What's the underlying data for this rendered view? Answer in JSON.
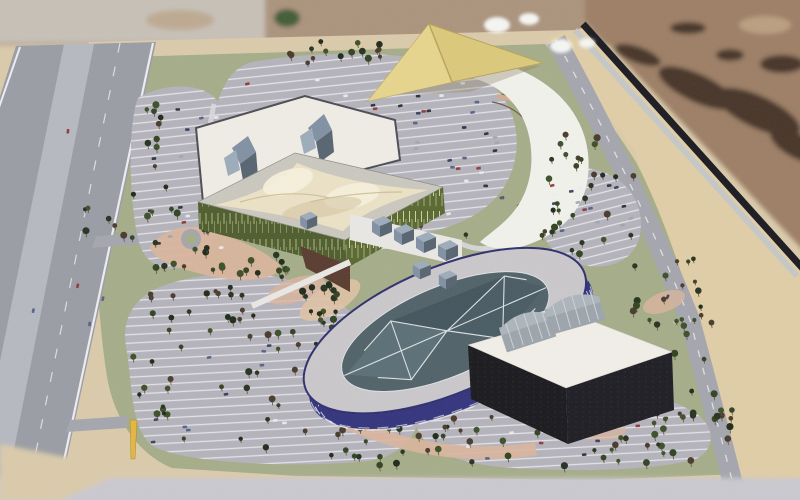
{
  "meta": {
    "description": "Photograph of an architectural scale model (site master plan maquette) showing an exhibition complex with an oval pavilion, tensile-roof hall, parking lots, trees, a highway and desert background",
    "image_type": "photo-of-physical-model"
  },
  "palette": {
    "ground": "#d8c8a8",
    "board_green": "#a3aa86",
    "top_blur": "#a8917a",
    "top_blur_light": "#c4beb4",
    "green_blob": "#3f5a36",
    "desert": "#9a7c62",
    "desert_shadow": "#453226",
    "desert_light": "#b89c7e",
    "bottom_blur": "#c8c6cd",
    "board_edge": "#17171d",
    "curb": "#c2c5c3",
    "sand": "#ddcba4",
    "highway": "#979aa2",
    "highway_median": "#b4b6be",
    "lane_white": "#eceaf0",
    "access_road": "#a2a3ab",
    "parking": "#b2b0b8",
    "parking_stripe": "#ededf2",
    "ring_road": "#d6d6db",
    "crescent": "#efefea",
    "blob_white": "#f3f3ef",
    "path_pink": "#d7b29a",
    "plaza_tan": "#dcc0a2",
    "terrace": "#d2a88d",
    "terrace2": "#c99e84",
    "terrace_dark": "#6e5647",
    "green_wall": "#57652f",
    "green_wall_dark": "#4c5a2b",
    "wall_stripe": "#c9d097",
    "roof_rim": "#c8c5bc",
    "tensile": "#e9dfc3",
    "tensile_hi": "#f4eeda",
    "tensile_sh": "#cdbd97",
    "white_bldg": "#edeae3",
    "bldg_outline": "#4a4a52",
    "glass_a": "#7e8ea0",
    "glass_b": "#55616e",
    "glass_c": "#9aa9b8",
    "deck": "#e6e5e1",
    "wedge_brown": "#57392c",
    "oval_wall": "#31317b",
    "oval_rim_line": "#2c2c6c",
    "oval_roof": "#c8c5c8",
    "oval_glass": "#4e5f66",
    "facet_light": "#5b6e75",
    "facet_dark": "#465860",
    "facet_apex": "#3f4f57",
    "mullion": "#d9dfe0",
    "wall_dash": "#e6e7ef",
    "dark_wall": "#17161b",
    "dark_wall2": "#1b1a20",
    "white_roof": "#efece6",
    "vault": "#9aa2a9",
    "vault_top": "#aab2b9",
    "vault_ridge": "#c9cfd4",
    "canopy": "#d9c678",
    "canopy_hi": "#e3d28a",
    "canopy_edge": "#b5a258",
    "obelisk": "#e0b43e",
    "trunk": "#5d4c38",
    "tree_colors": [
      "#24301d",
      "#2f401f",
      "#1c2817",
      "#46382a",
      "#3a4d26"
    ],
    "car_colors": [
      "#e8eaee",
      "#2a3658",
      "#4a5a80",
      "#8a2f33",
      "#9aa2b2",
      "#1e2430"
    ]
  },
  "scene": {
    "background": [
      "blurred-desert-horizon",
      "desert-ground-with-rock-shadows",
      "model-board-dark-edge"
    ],
    "buildings": [
      {
        "name": "white-exhibition-hall",
        "roof": "white flat",
        "features": "two angular glass roof sculptures"
      },
      {
        "name": "tensile-roof-hall",
        "walls": "olive green striped",
        "roof": "cream fabric tensile, twin peaks"
      },
      {
        "name": "oval-pavilion",
        "walls": "indigo with white window bands",
        "roof": "faceted teal glass skylight"
      },
      {
        "name": "dark-podium-building",
        "walls": "near-black",
        "roof": "white with two barrel vaults"
      },
      {
        "name": "glass-pavilion-row",
        "count": 8
      },
      {
        "name": "yellow-shade-canopy",
        "shape": "kite triangle"
      }
    ],
    "infrastructure": [
      "left-highway-with-lane-lines",
      "right-service-road",
      "white-crescent-ring-road",
      "roundabout",
      "pink-pedestrian-paths",
      "terraced-steps"
    ],
    "markers": [
      {
        "name": "yellow-obelisk",
        "position": "south-west parking"
      }
    ],
    "vegetation": {
      "clusters": [
        [
          146,
          88,
          20,
          182,
          16
        ],
        [
          170,
          118,
          58,
          136,
          11
        ],
        [
          240,
          50,
          205,
          16,
          12
        ],
        [
          250,
          222,
          220,
          16,
          11
        ],
        [
          84,
          192,
          58,
          46,
          8
        ],
        [
          138,
          284,
          205,
          14,
          18
        ],
        [
          150,
          310,
          200,
          14,
          16
        ],
        [
          172,
          262,
          120,
          12,
          9
        ],
        [
          130,
          326,
          290,
          132,
          55
        ],
        [
          330,
          424,
          185,
          42,
          20
        ],
        [
          430,
          366,
          280,
          102,
          58
        ],
        [
          588,
          352,
          120,
          66,
          18
        ],
        [
          618,
          296,
          100,
          42,
          13
        ],
        [
          540,
          170,
          100,
          98,
          26
        ],
        [
          532,
          132,
          66,
          36,
          9
        ],
        [
          228,
          246,
          58,
          40,
          6
        ],
        [
          654,
          246,
          48,
          66,
          8
        ],
        [
          688,
          368,
          44,
          76,
          9
        ],
        [
          300,
          38,
          84,
          14,
          6
        ]
      ]
    },
    "vehicles": {
      "groups": [
        [
          238,
          72,
          262,
          150,
          85,
          -6
        ],
        [
          142,
          102,
          82,
          148,
          16,
          -6
        ],
        [
          145,
          342,
          255,
          105,
          13,
          -3
        ],
        [
          445,
          378,
          240,
          80,
          11,
          -3
        ],
        [
          548,
          178,
          86,
          80,
          15,
          -14
        ],
        [
          30,
          120,
          80,
          260,
          5,
          -78
        ],
        [
          662,
          288,
          12,
          36,
          2,
          -62
        ]
      ]
    }
  }
}
